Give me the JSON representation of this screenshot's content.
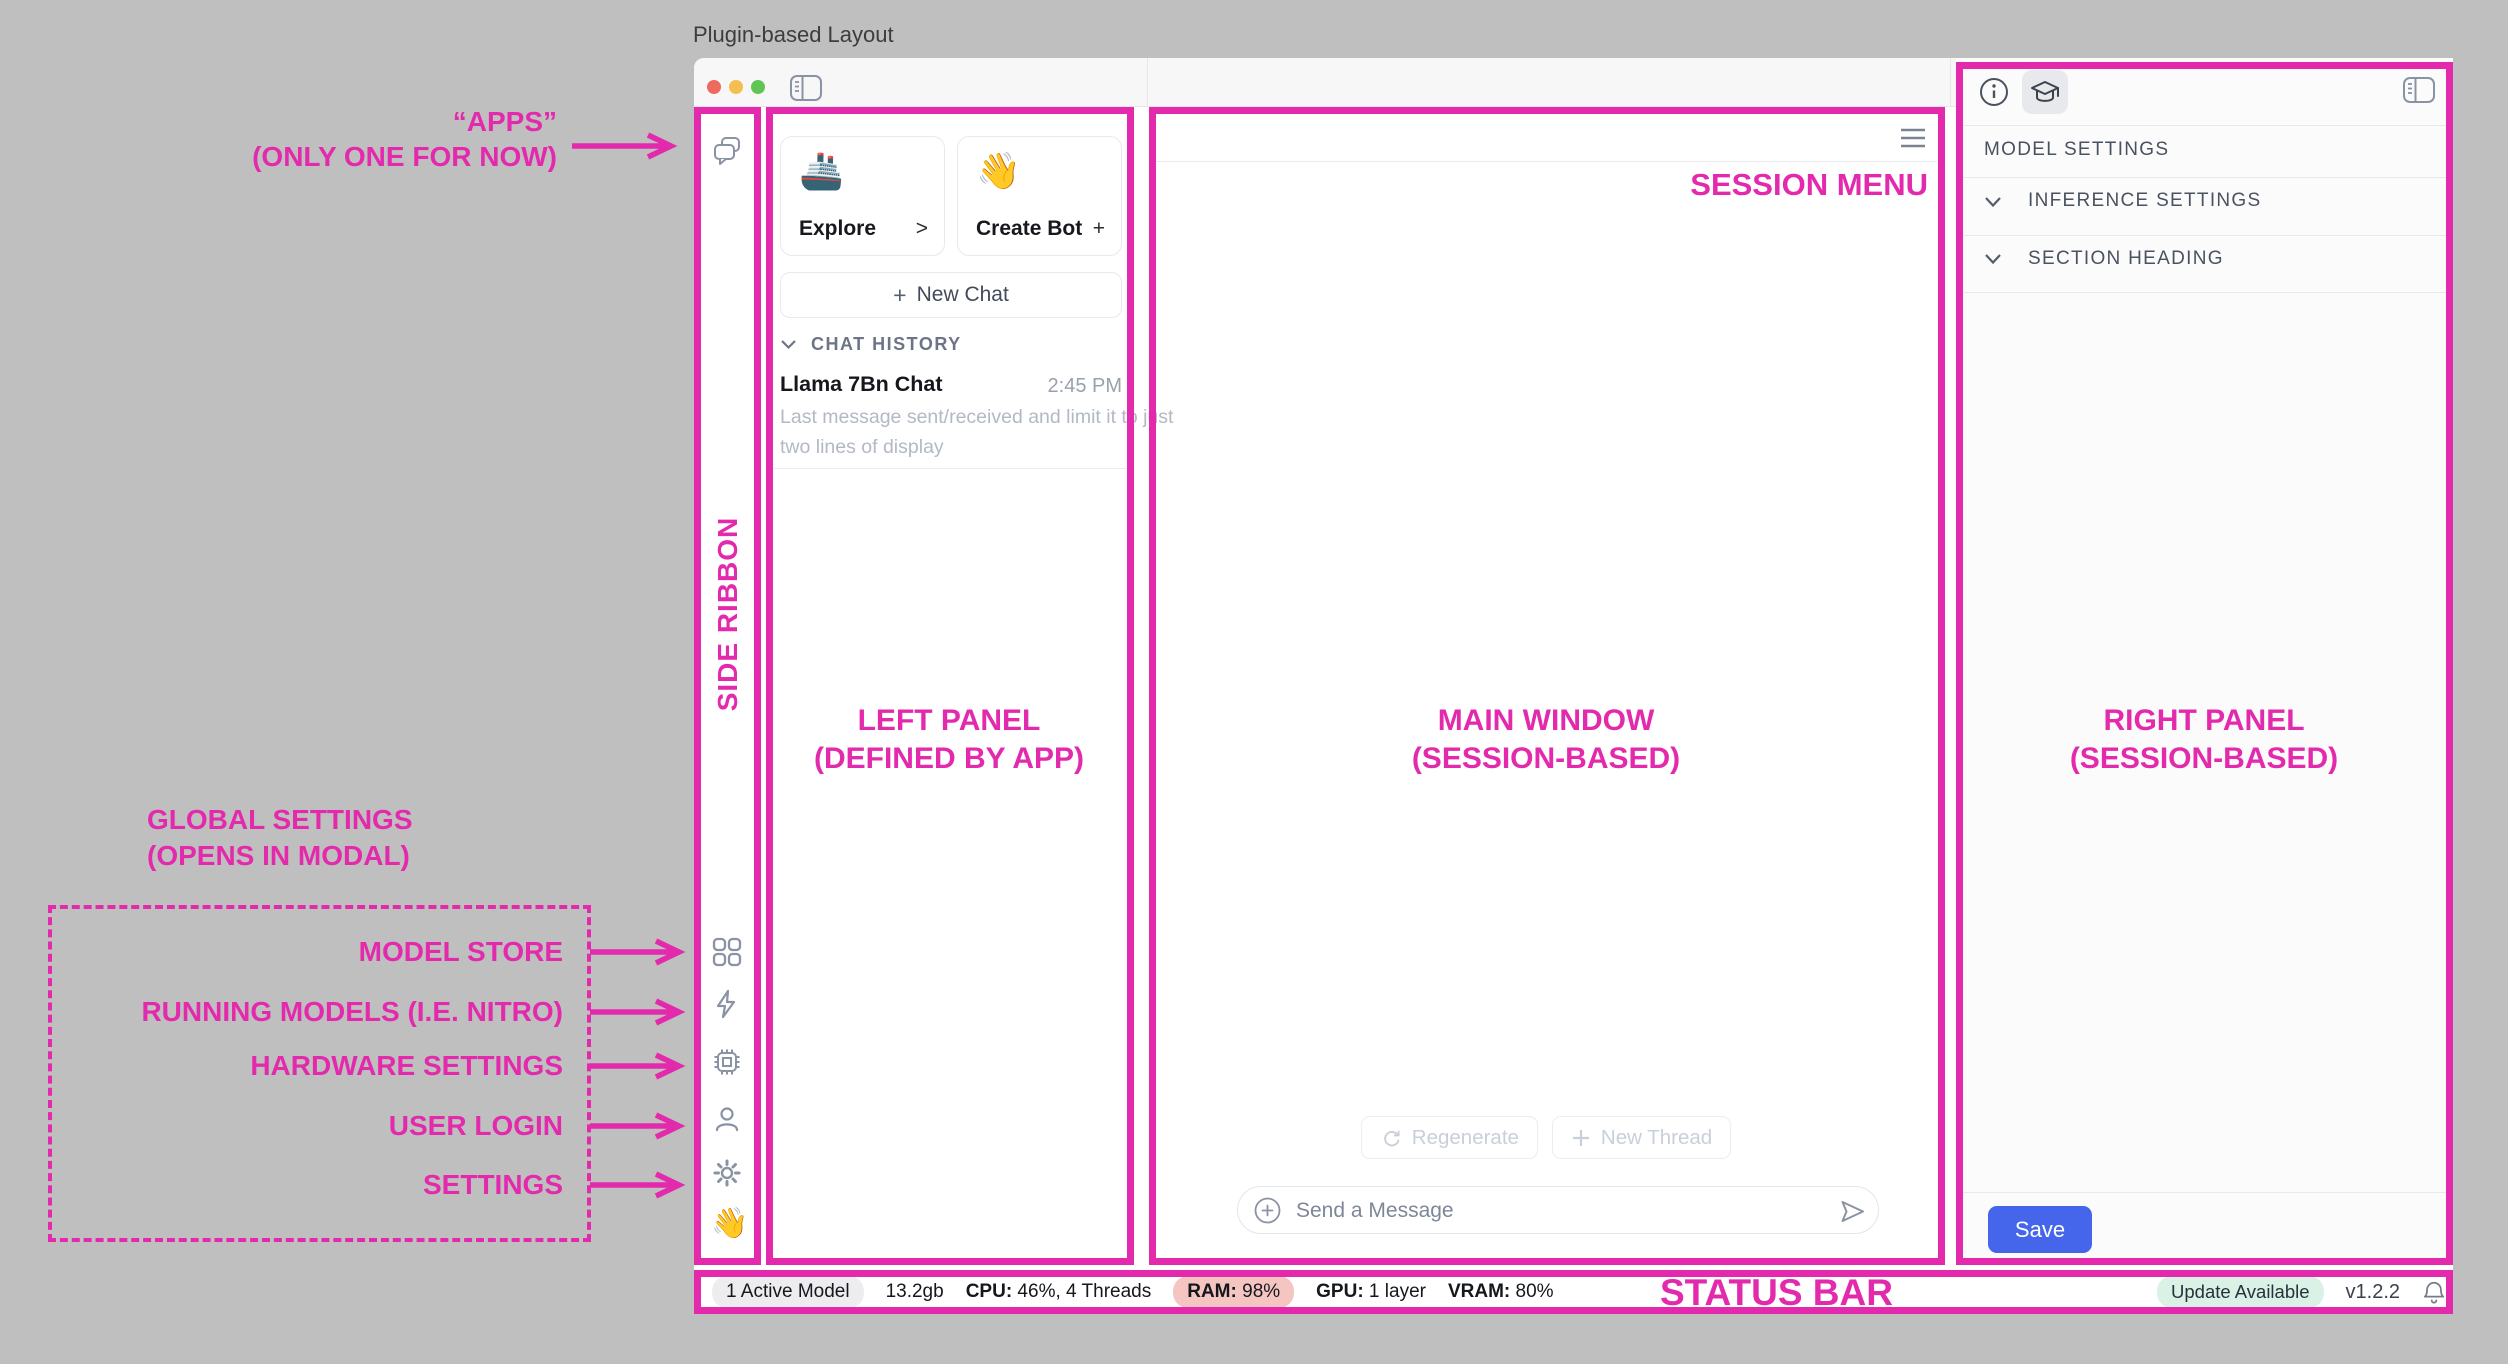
{
  "page_title": "Plugin-based Layout",
  "annotations": {
    "accent_color": "#e32aad",
    "apps": {
      "line1": "“APPS”",
      "line2": "(ONLY ONE FOR NOW)"
    },
    "side_ribbon": "SIDE RIBBON",
    "left_panel": {
      "line1": "LEFT PANEL",
      "line2": "(DEFINED BY APP)"
    },
    "main_window": {
      "line1": "MAIN WINDOW",
      "line2": "(SESSION-BASED)"
    },
    "right_panel": {
      "line1": "RIGHT PANEL",
      "line2": "(SESSION-BASED)"
    },
    "session_menu": "SESSION MENU",
    "status_bar": "STATUS BAR",
    "global_settings": {
      "line1": "GLOBAL SETTINGS",
      "line2": "(OPENS IN MODAL)"
    },
    "global_items": [
      {
        "label": "MODEL STORE"
      },
      {
        "label": "RUNNING MODELS (I.E. NITRO)"
      },
      {
        "label": "HARDWARE SETTINGS"
      },
      {
        "label": "USER LOGIN"
      },
      {
        "label": "SETTINGS"
      }
    ]
  },
  "ribbon": {
    "wave_emoji": "👋"
  },
  "left_panel": {
    "explore_card": {
      "emoji": "🚢",
      "label": "Explore",
      "accessory": ">"
    },
    "create_bot_card": {
      "emoji": "👋",
      "label": "Create Bot",
      "accessory": "+"
    },
    "new_chat_plus": "+",
    "new_chat_label": "New Chat",
    "chat_history_header": "CHAT HISTORY",
    "chat_item": {
      "title": "Llama 7Bn Chat",
      "time": "2:45 PM",
      "preview_line1": "Last message sent/received and limit it to just",
      "preview_line2": "two lines of display"
    }
  },
  "main": {
    "regenerate_label": "Regenerate",
    "new_thread_label": "New Thread",
    "composer_placeholder": "Send a Message"
  },
  "right_panel": {
    "model_settings": "MODEL SETTINGS",
    "inference_settings": "INFERENCE SETTINGS",
    "section_heading": "SECTION HEADING",
    "save_label": "Save"
  },
  "status_bar": {
    "active_model": "1 Active Model",
    "memory": "13.2gb",
    "cpu_label": "CPU:",
    "cpu_value": " 46%, 4 Threads",
    "ram_label": "RAM:",
    "ram_value": " 98%",
    "gpu_label": "GPU:",
    "gpu_value": " 1 layer",
    "vram_label": "VRAM:",
    "vram_value": " 80%",
    "update_badge": "Update Available",
    "version": "v1.2.2"
  },
  "colors": {
    "annotation_pink": "#e32aad",
    "save_blue": "#4565eb",
    "ram_pill": "#f5c6c1",
    "update_pill": "#daf2e6",
    "background_gray": "#bfbfbf"
  }
}
